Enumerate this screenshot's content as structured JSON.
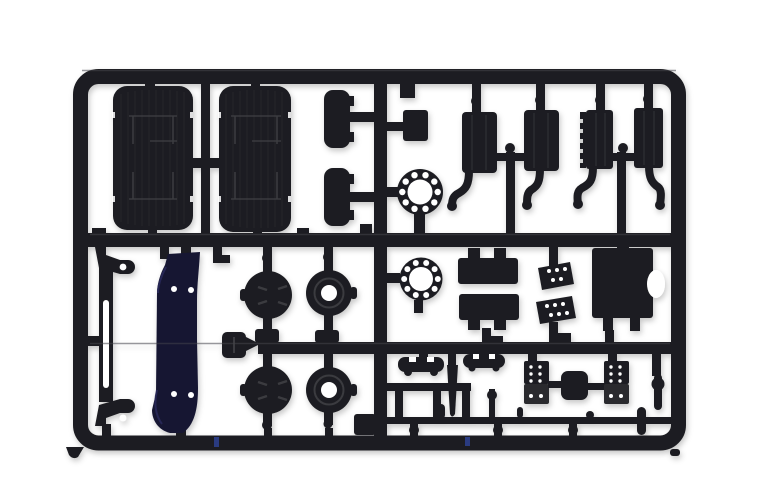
{
  "scene": {
    "description": "Photograph of a black injection-molded plastic model kit sprue (parts tree) on a white background",
    "object": "plastic-model-sprue"
  },
  "colors": {
    "background": "#ffffff",
    "plastic": "#1d1e21",
    "plastic_front": "#2a2b2e",
    "plastic_highlight": "#43444a",
    "detail_line": "#3a3b3f",
    "rib_line": "#2b2c30",
    "navy_plastic": "#151532",
    "navy_highlight": "#2a2a58",
    "hole": "#ffffff",
    "blue_mark": "#2c3f92"
  },
  "parts_inventory": [
    {
      "name": "mudguard",
      "count": 2
    },
    {
      "name": "mudflap-bracket",
      "count": 2
    },
    {
      "name": "air-tank-with-pipe",
      "count": 4
    },
    {
      "name": "hub-ring",
      "count": 2
    },
    {
      "name": "wheel-hub-solid",
      "count": 2
    },
    {
      "name": "wheel-hub-holed",
      "count": 2
    },
    {
      "name": "chassis-bracket",
      "count": 1
    },
    {
      "name": "fender-liner-navy",
      "count": 1
    },
    {
      "name": "battery-box",
      "count": 1
    },
    {
      "name": "step-plate",
      "count": 2
    },
    {
      "name": "rectangular-tank",
      "count": 2
    },
    {
      "name": "sun-visor",
      "count": 2
    },
    {
      "name": "ladder-frame",
      "count": 1
    },
    {
      "name": "pedal-box",
      "count": 2
    },
    {
      "name": "linkage-rod",
      "count": 1
    },
    {
      "name": "mount-cube",
      "count": 1
    }
  ]
}
